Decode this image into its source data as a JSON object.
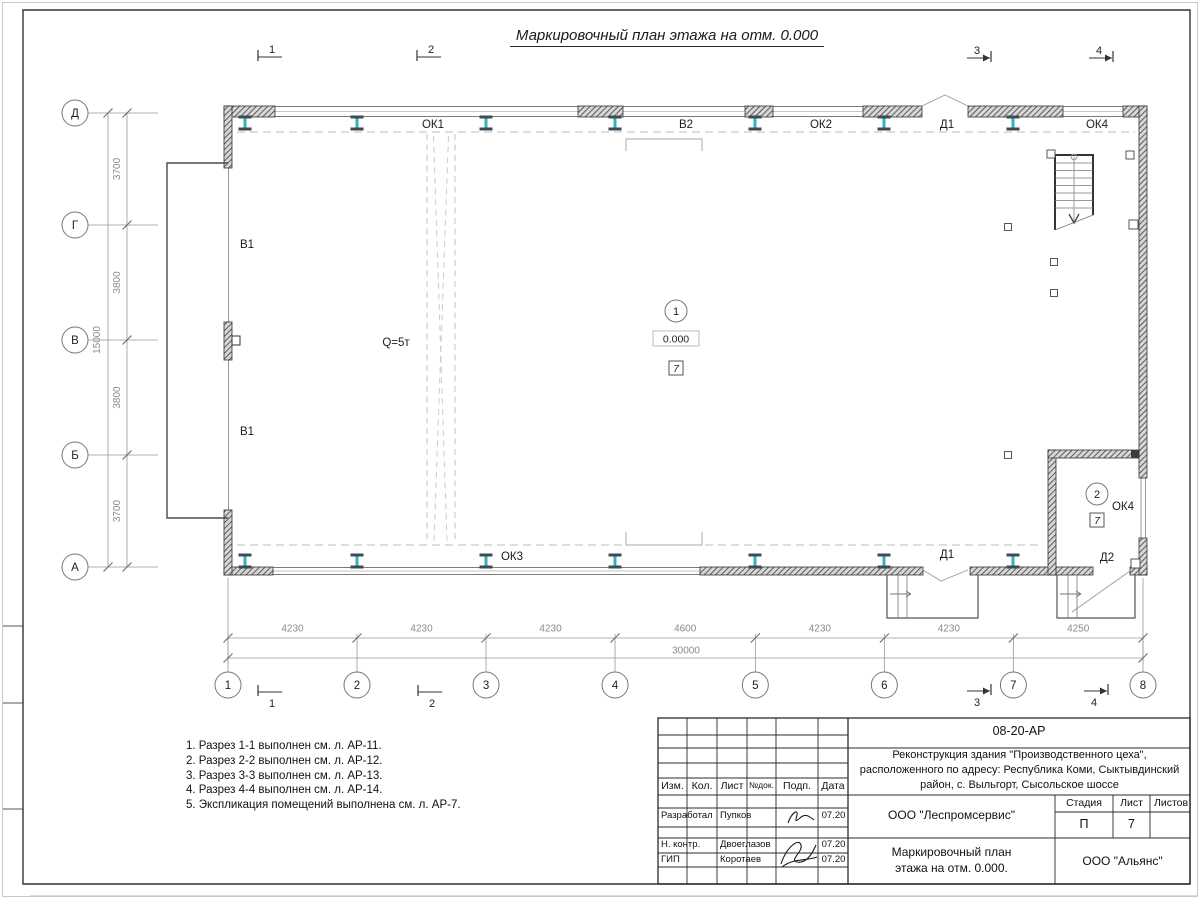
{
  "sheet": {
    "title": "Маркировочный план этажа на отм. 0.000"
  },
  "colors": {
    "column_web": "#2fb3bd",
    "column_flange": "#3f4b54",
    "dim_line": "#999999",
    "dim_text": "#8a8a8a",
    "label_text": "#1c1c1c"
  },
  "grid": {
    "cols": {
      "labels": [
        "1",
        "2",
        "3",
        "4",
        "5",
        "6",
        "7",
        "8"
      ],
      "spans": [
        4230,
        4230,
        4230,
        4600,
        4230,
        4230,
        4250
      ],
      "total_label": "30000"
    },
    "rows": {
      "labels": [
        "Д",
        "Г",
        "В",
        "Б",
        "А"
      ],
      "spans": [
        3700,
        3800,
        3800,
        3700
      ],
      "total_label": "15000"
    }
  },
  "plan": {
    "marks": [
      {
        "text": "ОК1",
        "x": 433,
        "y": 124
      },
      {
        "text": "В2",
        "x": 686,
        "y": 124
      },
      {
        "text": "ОК2",
        "x": 821,
        "y": 124
      },
      {
        "text": "Д1",
        "x": 947,
        "y": 124
      },
      {
        "text": "ОК4",
        "x": 1097,
        "y": 124
      },
      {
        "text": "В1",
        "x": 247,
        "y": 244
      },
      {
        "text": "В1",
        "x": 247,
        "y": 431
      },
      {
        "text": "Q=5т",
        "x": 396,
        "y": 342
      },
      {
        "text": "ОК3",
        "x": 512,
        "y": 556
      },
      {
        "text": "Д1",
        "x": 947,
        "y": 554
      },
      {
        "text": "Д2",
        "x": 1107,
        "y": 557
      },
      {
        "text": "ОК4",
        "x": 1123,
        "y": 506
      }
    ],
    "rooms": [
      {
        "num": "1",
        "x": 676,
        "y": 311,
        "elev": "0.000",
        "type": "7"
      },
      {
        "num": "2",
        "x": 1097,
        "y": 494,
        "type": "7"
      }
    ],
    "sections": [
      {
        "num": "1",
        "dir": "left",
        "x": 258,
        "y": 57,
        "np": "above"
      },
      {
        "num": "2",
        "dir": "left",
        "x": 417,
        "y": 57,
        "np": "above"
      },
      {
        "num": "3",
        "dir": "right",
        "x": 991,
        "y": 58,
        "np": "above"
      },
      {
        "num": "4",
        "dir": "right",
        "x": 1113,
        "y": 58,
        "np": "above"
      },
      {
        "num": "1",
        "dir": "left",
        "x": 258,
        "y": 692,
        "np": "below"
      },
      {
        "num": "2",
        "dir": "left",
        "x": 418,
        "y": 692,
        "np": "below"
      },
      {
        "num": "3",
        "dir": "right",
        "x": 991,
        "y": 691,
        "np": "below"
      },
      {
        "num": "4",
        "dir": "right",
        "x": 1108,
        "y": 691,
        "np": "below"
      }
    ]
  },
  "notes": [
    "1. Разрез 1-1 выполнен см. л. АР-11.",
    "2. Разрез 2-2 выполнен см. л. АР-12.",
    "3. Разрез 3-3 выполнен см. л. АР-13.",
    "4. Разрез 4-4 выполнен см. л. АР-14.",
    "5. Экспликация помещений выполнена см. л. АР-7."
  ],
  "titleblock": {
    "doc_number": "08-20-АР",
    "project_lines": [
      "Реконструкция здания \"Производственного цеха\",",
      "расположенного по адресу: Республика Коми, Сыктывдинский",
      "район, с. Выльгорт, Сысольское шоссе"
    ],
    "columns": [
      "Изм.",
      "Кол.",
      "Лист",
      "№док.",
      "Подп.",
      "Дата"
    ],
    "org": "ООО \"Леспромсервис\"",
    "stage_header": [
      "Стадия",
      "Лист",
      "Листов"
    ],
    "stage": "П",
    "sheet_num": "7",
    "drawing_title_lines": [
      "Маркировочный план",
      "этажа на отм. 0.000."
    ],
    "company": "ООО \"Альянс\"",
    "roles": [
      {
        "role": "Разработал",
        "name": "Пупков",
        "date": "07.20"
      },
      {
        "role": "Н. контр.",
        "name": "Двоеглазов",
        "date": "07.20"
      },
      {
        "role": "ГИП",
        "name": "Коротаев",
        "date": "07.20"
      }
    ]
  }
}
